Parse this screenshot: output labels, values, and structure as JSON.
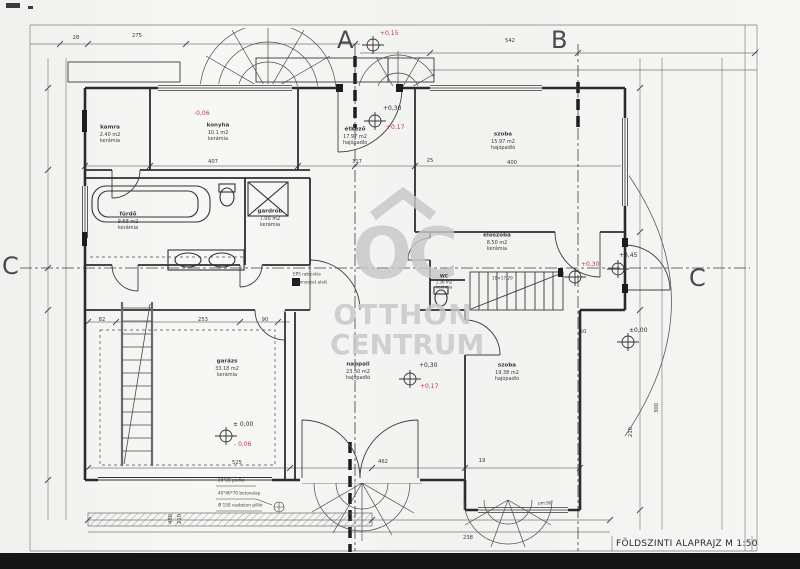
{
  "page": {
    "background": "#f5f5f3",
    "ink": "#2e2e2e",
    "red": "#c03a4c",
    "watermark_gray": "#c8c8c8"
  },
  "title_block": {
    "title": "FÖLDSZINTI ALAPRAJZ M 1:50"
  },
  "watermark": {
    "logo": "OC",
    "line1": "OTTHON",
    "line2": "CENTRUM"
  },
  "grid_labels": {
    "a": "A",
    "b": "B",
    "c_left": "C",
    "c_right": "C"
  },
  "rooms": [
    {
      "name": "kamra",
      "area": "2.40 m2",
      "floor": "kerámia"
    },
    {
      "name": "konyha",
      "area": "10.1 m2",
      "floor": "kerámia"
    },
    {
      "name": "étkező",
      "area": "17.97 m2",
      "floor": "hajópadló"
    },
    {
      "name": "szoba",
      "area": "15.97 m2",
      "floor": "hajópadló"
    },
    {
      "name": "fürdő",
      "area": "9.68 m2",
      "floor": "kerámia"
    },
    {
      "name": "gardrób",
      "area": "7.00 m2",
      "floor": "kerámia"
    },
    {
      "name": "előszoba",
      "area": "8.50 m2",
      "floor": "kerámia"
    },
    {
      "name": "WC",
      "area": "1.36 m2",
      "floor": "kerámia"
    },
    {
      "name": "garázs",
      "area": "33.18 m2",
      "floor": "kerámia"
    },
    {
      "name": "nappali",
      "area": "23.50 m2",
      "floor": "hajópadló"
    },
    {
      "name": "szoba",
      "area": "19.38 m2",
      "floor": "hajópadló"
    }
  ],
  "levels": {
    "entrance": "+0,15",
    "kitchen": "-0,06",
    "dining_main": "+0,30",
    "dining_red": "+0,17",
    "hall_red": "+0,30",
    "hall_main": "+0,45",
    "right_zero": "±0,00",
    "living_main": "+0,30",
    "living_red": "+0,17",
    "garage_zero": "± 0,00",
    "garage_red": "- 0,06"
  },
  "dimensions": [
    "275",
    "542",
    "28",
    "407",
    "317",
    "25",
    "400",
    "82",
    "253",
    "90",
    "525",
    "462",
    "19",
    "238",
    "480",
    "210",
    "300",
    "50",
    "210"
  ],
  "annotations": {
    "note1": "20*20 padka",
    "note2": "40*40*70 betonalap",
    "note3": "Ø 150 vasbeton pillér",
    "eps1": "EPS rabicolás",
    "eps2": "mennyezet alatt",
    "stair": "18×17/29",
    "parapet": "pm:90"
  }
}
